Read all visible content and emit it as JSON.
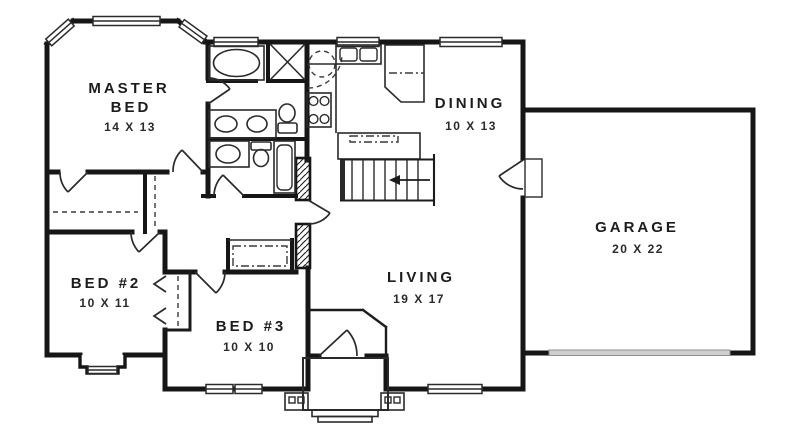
{
  "plan": {
    "type": "single-story house floor plan",
    "colors": {
      "background": "#ffffff",
      "wall": "#161616",
      "text": "#1c1c1c",
      "garage_door_fill": "#cfcfcf",
      "garage_door_stroke": "#8f8f8f"
    },
    "rooms": {
      "master_bed": {
        "name_line1": "MASTER",
        "name_line2": "BED",
        "dims": "14 X 13"
      },
      "dining": {
        "name": "DINING",
        "dims": "10 X 13"
      },
      "garage": {
        "name": "GARAGE",
        "dims": "20 X 22"
      },
      "living": {
        "name": "LIVING",
        "dims": "19 X 17"
      },
      "bed2": {
        "name": "BED #2",
        "dims": "10 X 11"
      },
      "bed3": {
        "name": "BED #3",
        "dims": "10 X 10"
      }
    },
    "symbols": {
      "stairs_arrow": "stairs direction arrow pointing left (down)",
      "closet_x": "X-braced linen closet",
      "hatch": "masonry / chase wall hatching"
    }
  }
}
